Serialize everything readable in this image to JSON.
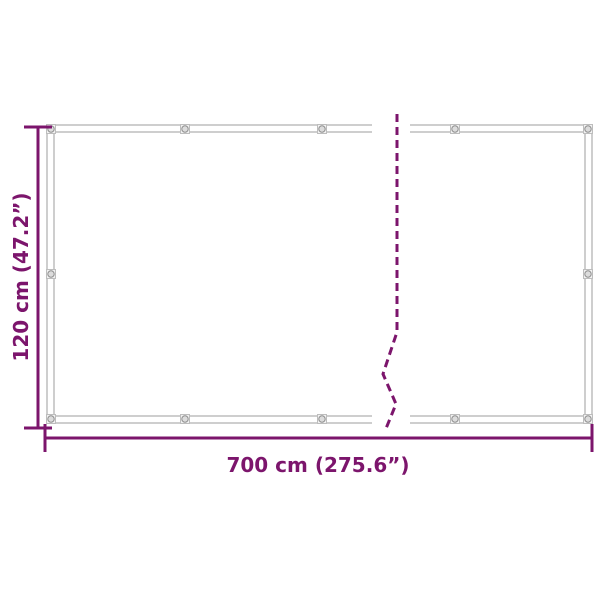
{
  "diagram": {
    "kind": "product-dimension-diagram",
    "dimensions": {
      "height": {
        "label": "120 cm (47.2”)",
        "cm": 120,
        "inches": 47.2
      },
      "width": {
        "label": "700 cm (275.6”)",
        "cm": 700,
        "inches": 275.6
      }
    },
    "colors": {
      "dimension_accent": "#7C156C",
      "frame_line": "#9D9D9D",
      "grommet_fill": "#DCDCDC",
      "grommet_plate": "#F0F0F0",
      "background": "#FFFFFF"
    },
    "icons": {
      "grommet": "small-circle-eyelet",
      "break_line": "dashed-zigzag"
    }
  }
}
